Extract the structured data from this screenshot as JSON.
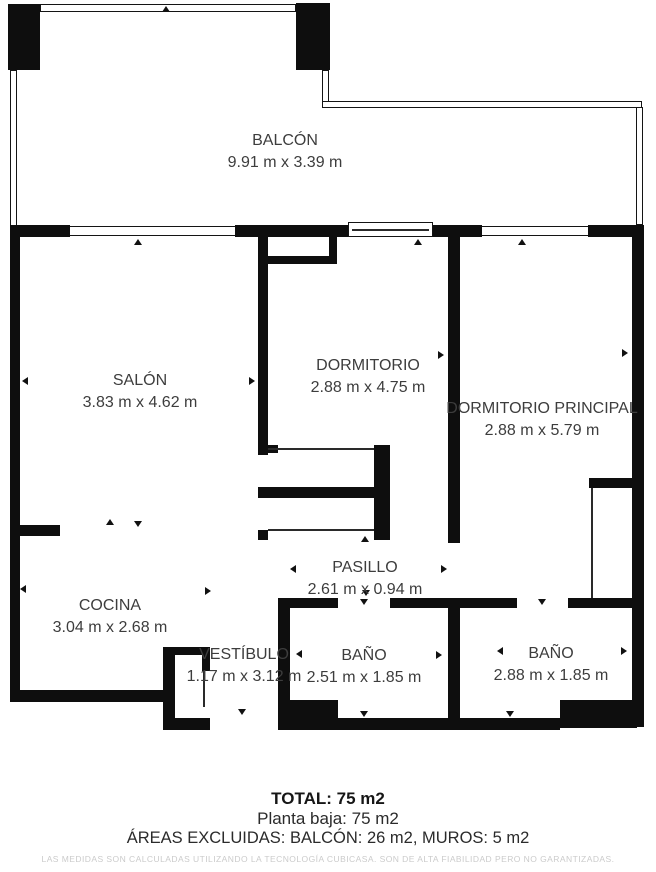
{
  "plan": {
    "rooms": [
      {
        "name": "BALCÓN",
        "dims": "9.91 m x 3.39 m"
      },
      {
        "name": "SALÓN",
        "dims": "3.83 m x 4.62 m"
      },
      {
        "name": "DORMITORIO",
        "dims": "2.88 m x 4.75 m"
      },
      {
        "name": "DORMITORIO PRINCIPAL",
        "dims": "2.88 m x 5.79 m"
      },
      {
        "name": "COCINA",
        "dims": "3.04 m x 2.68 m"
      },
      {
        "name": "PASILLO",
        "dims": "2.61 m x 0.94 m"
      },
      {
        "name": "VESTÍBULO",
        "dims": "1.17 m x 3.12 m"
      },
      {
        "name": "BAÑO",
        "dims": "2.51 m x 1.85 m"
      },
      {
        "name": "BAÑO",
        "dims": "2.88 m x 1.85 m"
      }
    ],
    "summary": {
      "total": "TOTAL: 75 m2",
      "floor": "Planta baja: 75 m2",
      "excluded": "ÁREAS EXCLUIDAS: BALCÓN: 26 m2, MUROS: 5 m2"
    },
    "disclaimer": "LAS MEDIDAS SON CALCULADAS UTILIZANDO LA TECNOLOGÍA CUBICASA. SON DE ALTA FIABILIDAD PERO NO GARANTIZADAS.",
    "colors": {
      "wall": "#0e0e0e",
      "label_text": "#3d3d3d",
      "disclaimer_text": "#cbcbcb"
    }
  }
}
